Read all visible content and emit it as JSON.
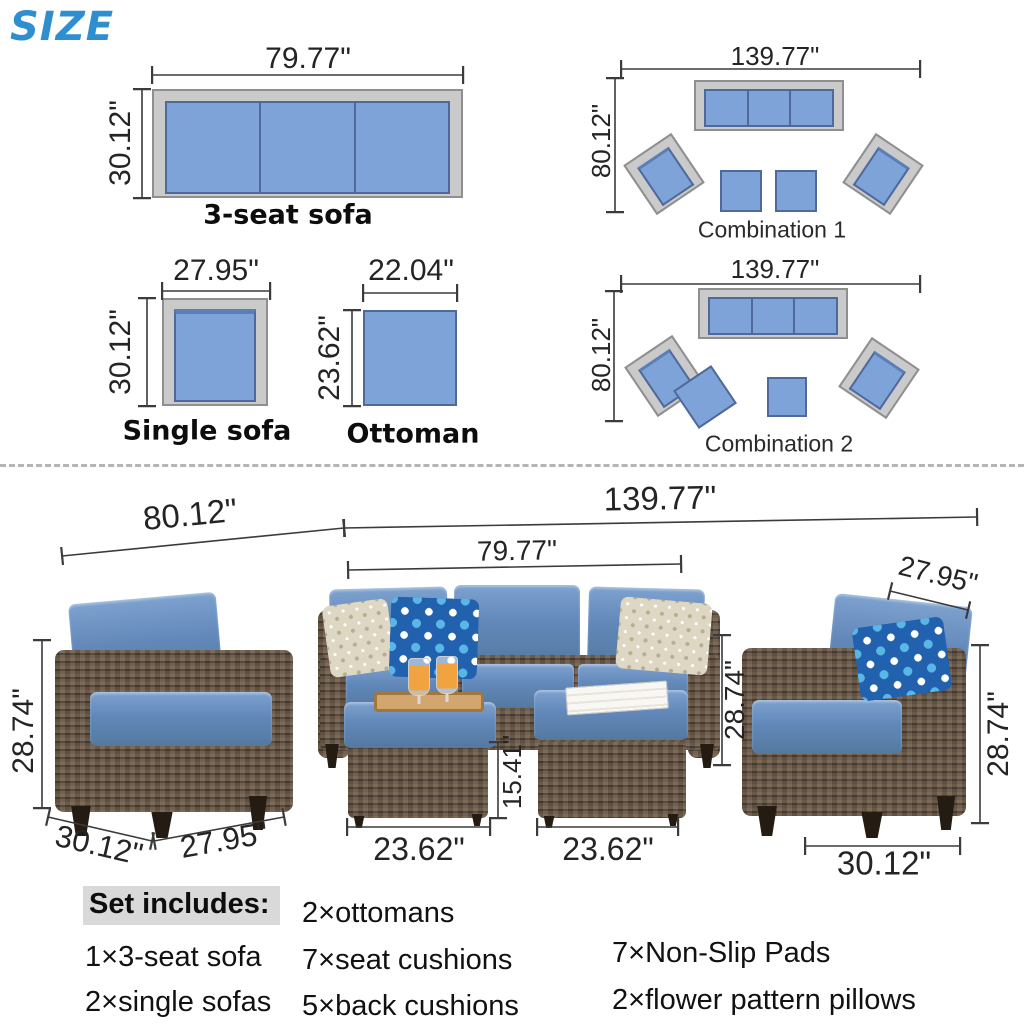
{
  "page_title": "SIZE",
  "colors": {
    "accent_blue": "#2e8fd0",
    "diagram_cushion_blue": "#7da3d8",
    "diagram_frame_gray": "#cacaca",
    "photo_cushion_blue": "#6288ba",
    "wicker_brown": "#5f5144",
    "dim_line": "#3b3b3b",
    "highlight_gray": "#d9d9d9"
  },
  "top": {
    "three_seat": {
      "name": "3-seat sofa",
      "width": "79.77\"",
      "depth": "30.12\""
    },
    "single": {
      "name": "Single sofa",
      "width": "27.95\"",
      "depth": "30.12\""
    },
    "ottoman": {
      "name": "Ottoman",
      "width": "22.04\"",
      "depth": "23.62\""
    },
    "combo1": {
      "name": "Combination 1",
      "width": "139.77\"",
      "depth": "80.12\""
    },
    "combo2": {
      "name": "Combination 2",
      "width": "139.77\"",
      "depth": "80.12\""
    }
  },
  "photo": {
    "arc_depth": "80.12\"",
    "arc_width": "139.77\"",
    "sofa_width": "79.77\"",
    "sofa_height": "28.74\"",
    "ottoman1_width": "23.62\"",
    "ottoman2_width": "23.62\"",
    "ottoman_height": "15.41\"",
    "left_chair": {
      "height": "28.74\"",
      "depth": "30.12\"",
      "width": "27.95\""
    },
    "right_chair": {
      "width": "27.95\"",
      "height": "28.74\"",
      "depth": "30.12\""
    }
  },
  "set_includes": {
    "heading": "Set includes:",
    "items_col1": [
      "1×3-seat sofa",
      "2×single sofas"
    ],
    "items_col2": [
      "2×ottomans",
      "7×seat cushions",
      "5×back cushions"
    ],
    "items_col3": [
      "7×Non-Slip Pads",
      "2×flower pattern pillows"
    ]
  }
}
